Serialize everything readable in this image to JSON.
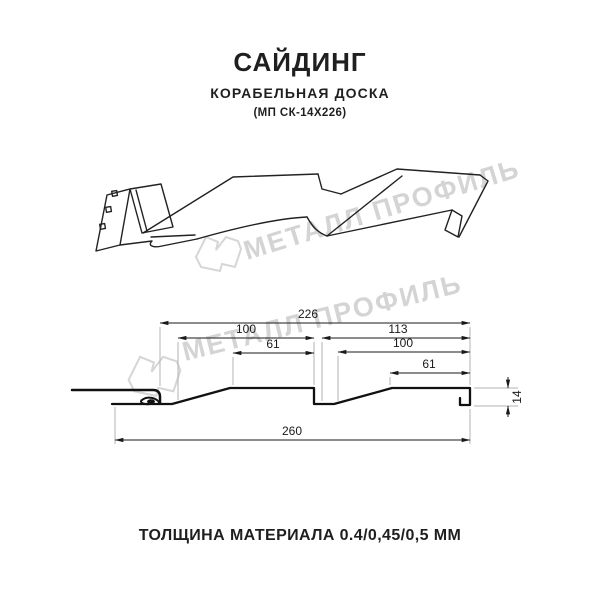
{
  "header": {
    "title": "САЙДИНГ",
    "subtitle": "КОРАБЕЛЬНАЯ ДОСКА",
    "model": "(МП СК-14Х226)"
  },
  "watermark": {
    "brand_text": "МЕТАЛЛ ПРОФИЛЬ",
    "color": "#d4d4d4"
  },
  "icons": {
    "watermark_logo": "metall-profil-house-logo"
  },
  "cross_section": {
    "dimensions": {
      "overall_top": "226",
      "left_pitch": "100",
      "left_flat": "61",
      "right_total": "113",
      "right_pitch": "100",
      "right_flat": "61",
      "overall_bottom": "260",
      "height": "14"
    }
  },
  "footer": {
    "thickness_note": "ТОЛЩИНА МАТЕРИАЛА 0.4/0,45/0,5 ММ"
  }
}
